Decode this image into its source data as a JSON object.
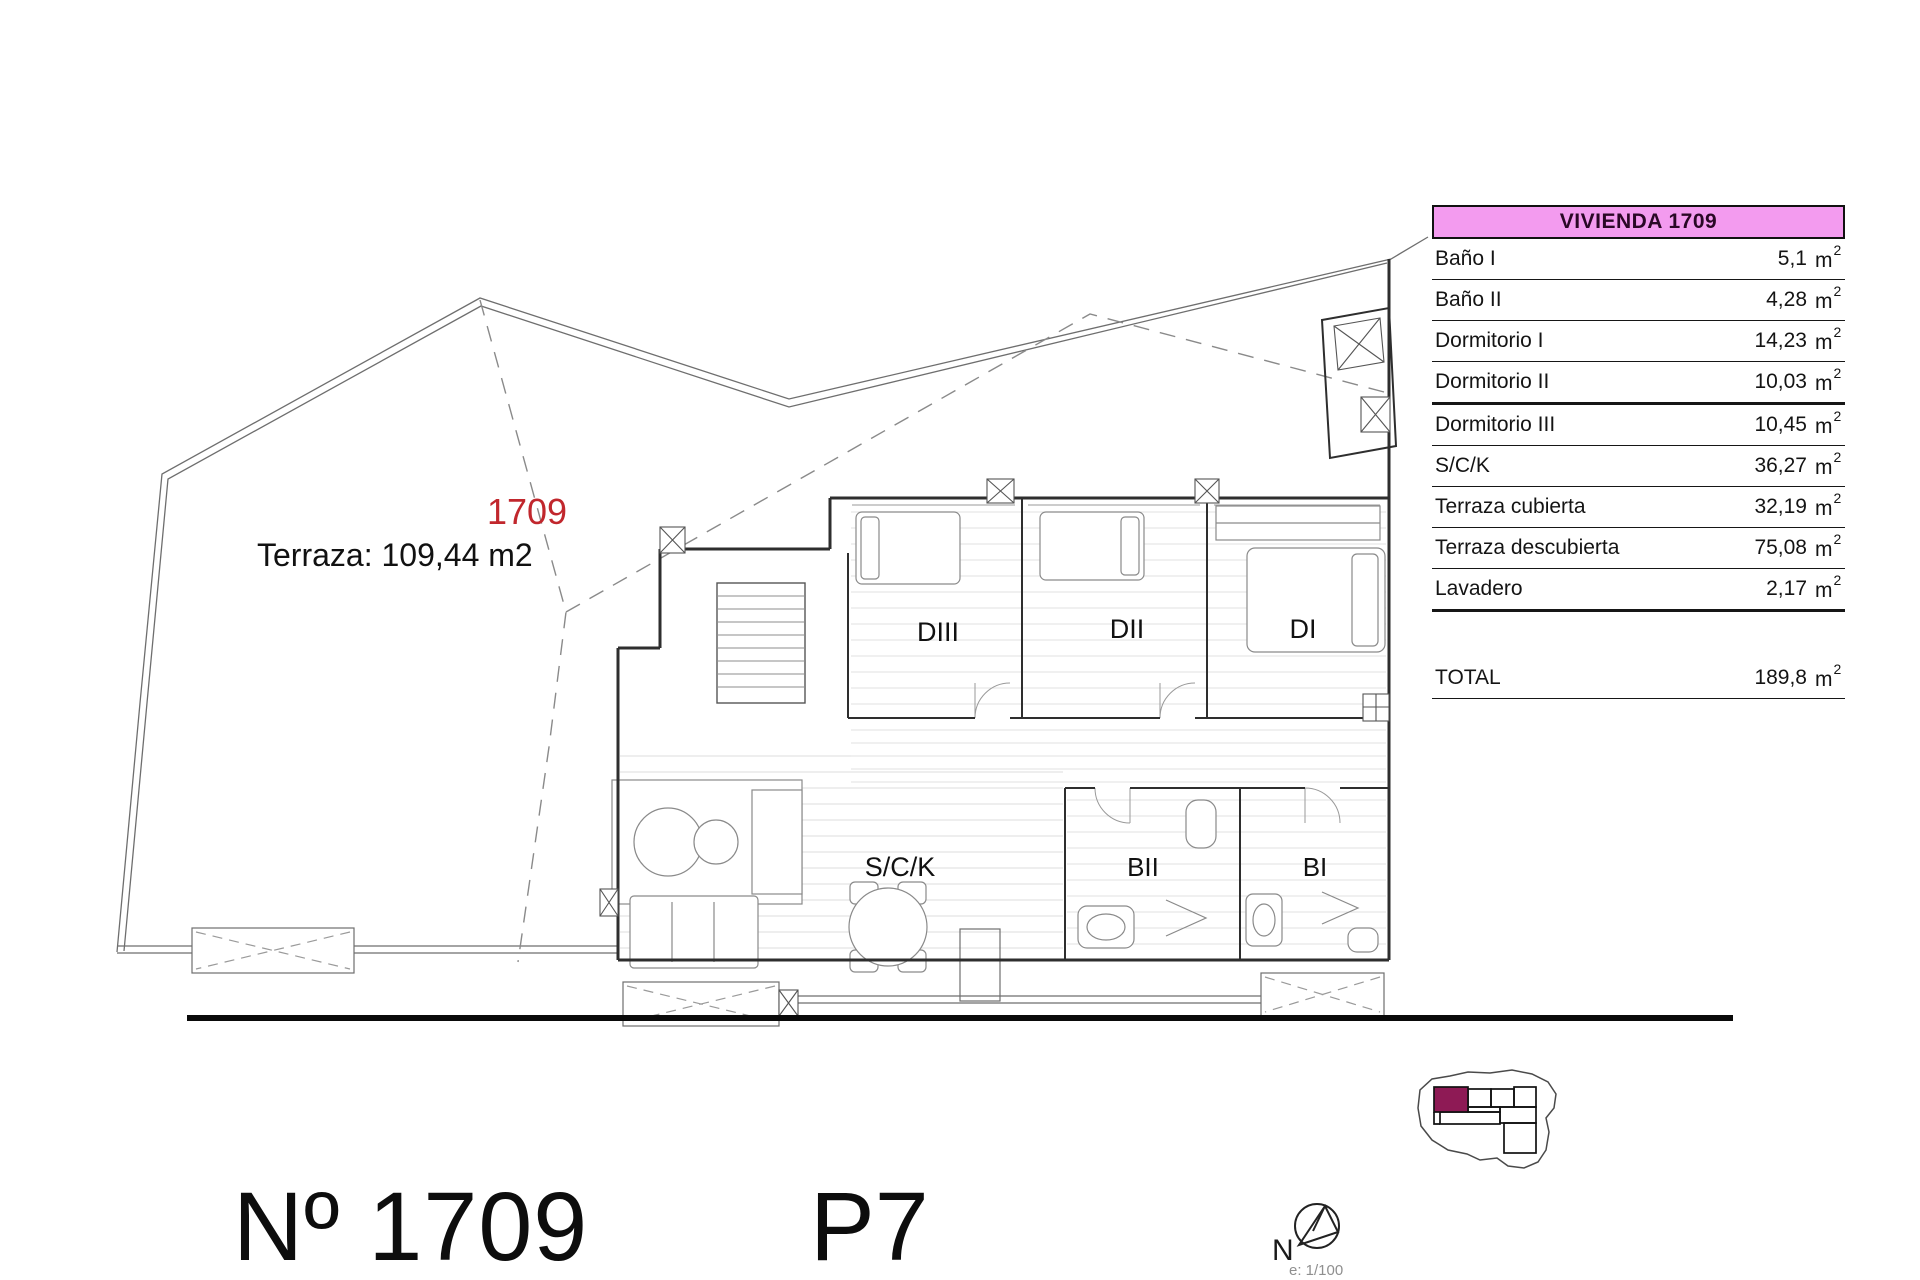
{
  "plan": {
    "unit_number_label": "1709",
    "terrace_label": "Terraza: 109,44 m2",
    "room_labels": {
      "diii": "DIII",
      "dii": "DII",
      "di": "DI",
      "sck": "S/C/K",
      "bii": "BII",
      "bi": "BI"
    }
  },
  "table": {
    "header": "VIVIENDA 1709",
    "unit_base": "m",
    "unit_sup": "2",
    "rows": [
      {
        "label": "Baño I",
        "value": "5,1",
        "thick": false
      },
      {
        "label": "Baño II",
        "value": "4,28",
        "thick": false
      },
      {
        "label": "Dormitorio I",
        "value": "14,23",
        "thick": false
      },
      {
        "label": "Dormitorio II",
        "value": "10,03",
        "thick": true
      },
      {
        "label": "Dormitorio III",
        "value": "10,45",
        "thick": false
      },
      {
        "label": "S/C/K",
        "value": "36,27",
        "thick": false
      },
      {
        "label": "Terraza cubierta",
        "value": "32,19",
        "thick": false
      },
      {
        "label": "Terraza descubierta",
        "value": "75,08",
        "thick": false
      },
      {
        "label": "Lavadero",
        "value": "2,17",
        "thick": true
      }
    ],
    "total_label": "TOTAL",
    "total_value": "189,8"
  },
  "footer": {
    "number": "Nº 1709",
    "floor": "P7",
    "north_label": "N",
    "scale_label": "e: 1/100"
  },
  "colors": {
    "accent_red": "#C1272D",
    "keyplan_highlight": "#8E1A55",
    "table_header_bg": "#F39BEF"
  }
}
